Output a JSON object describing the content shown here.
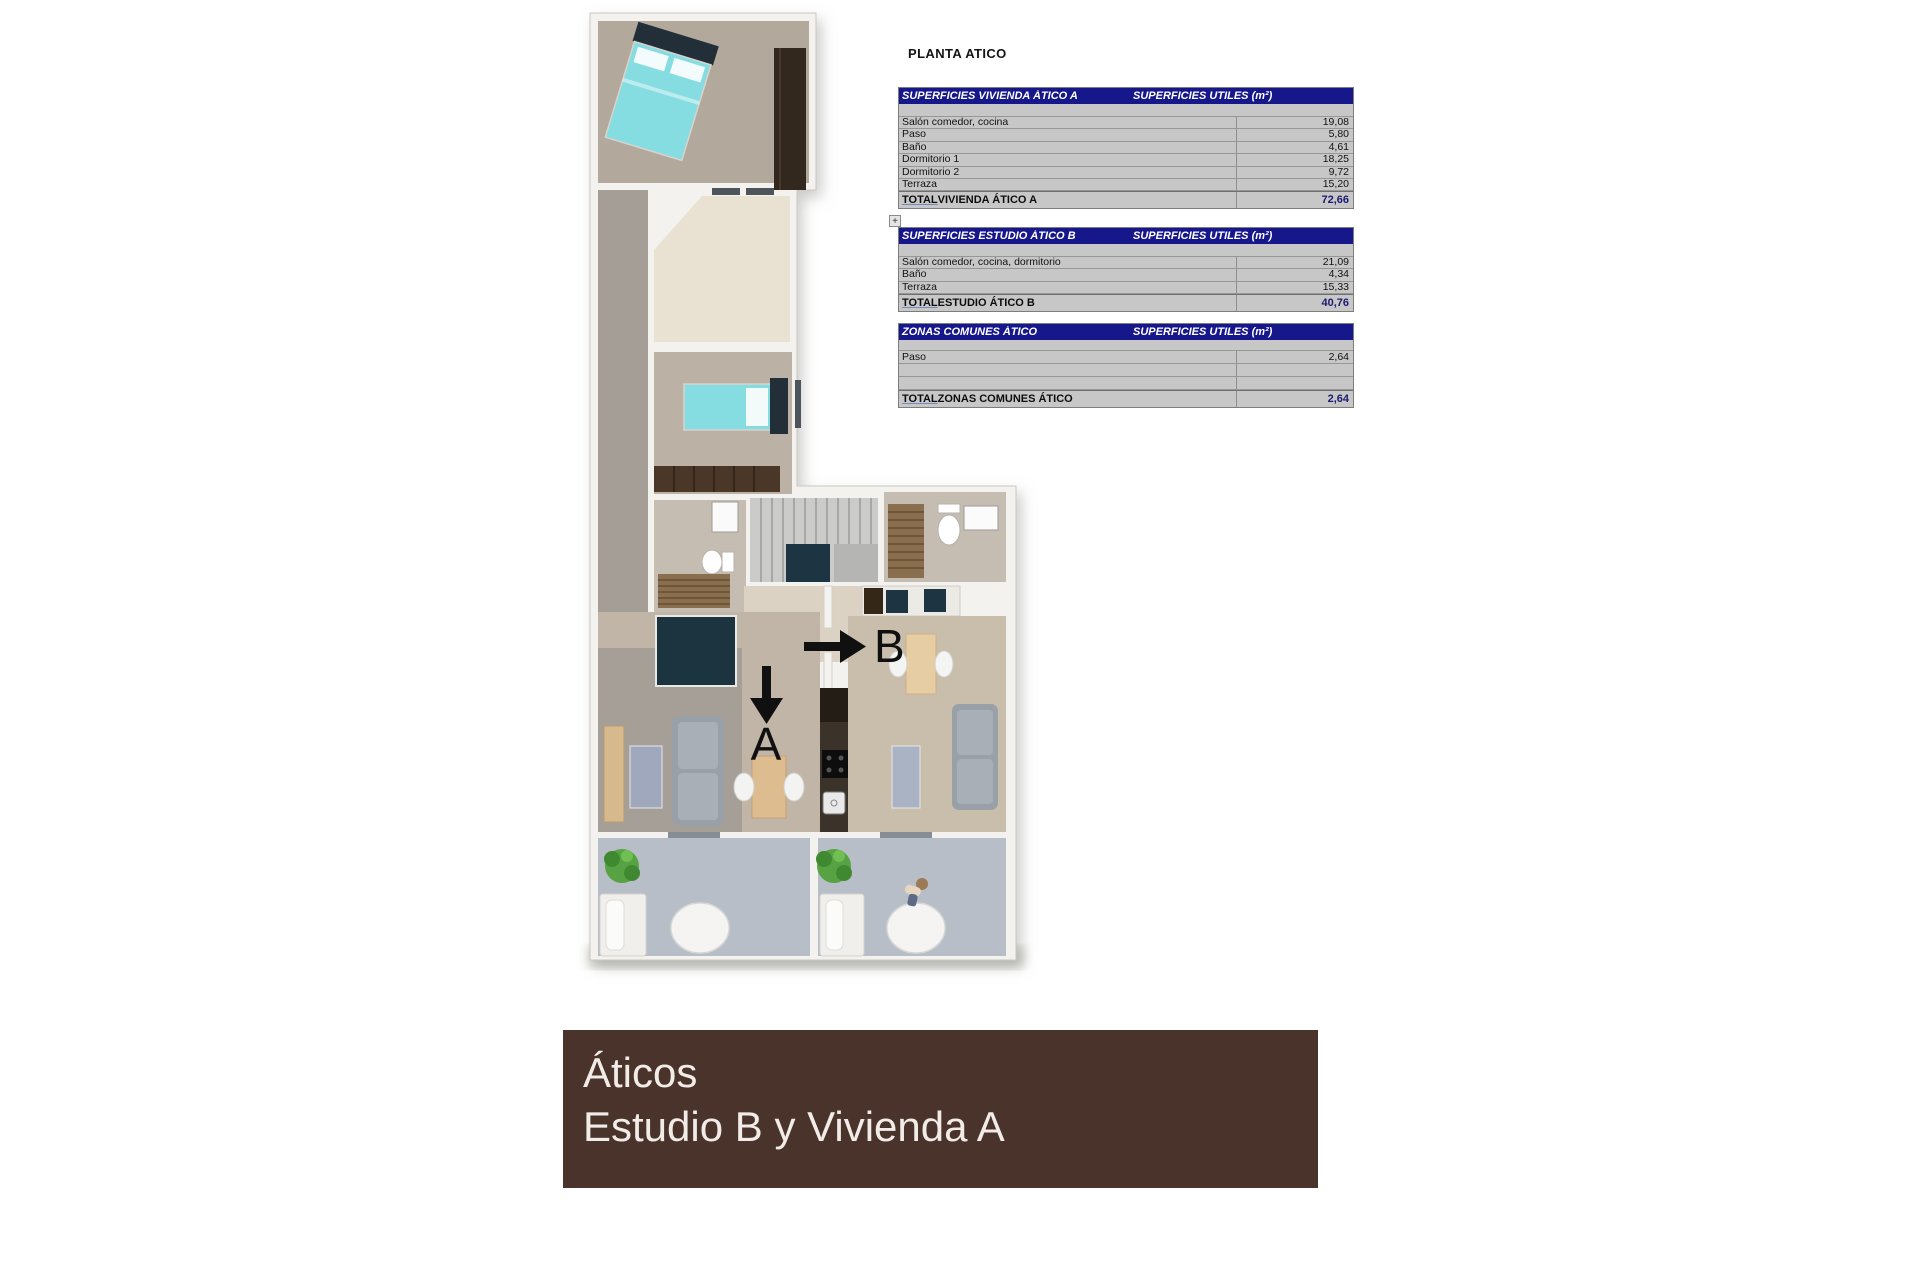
{
  "page_title": "PLANTA ATICO",
  "expand_icon_label": "+",
  "colors": {
    "table_header_bg": "#17178c",
    "table_header_fg": "#ffffff",
    "table_body_bg": "#c7c7c7",
    "total_value_fg": "#1b1b70",
    "banner_bg": "#4a332b",
    "banner_fg": "#f2ece8",
    "bed_teal": "#85dde1",
    "navy_block": "#1c3340",
    "terrace_floor": "#b8bec7"
  },
  "tables": [
    {
      "title": "SUPERFICIES VIVIENDA ÁTICO A",
      "units_header": "SUPERFICIES UTILES  (m²)",
      "rows": [
        [
          "Salón comedor, cocina",
          "19,08"
        ],
        [
          "Paso",
          "5,80"
        ],
        [
          "Baño",
          "4,61"
        ],
        [
          "Dormitorio 1",
          "18,25"
        ],
        [
          "Dormitorio 2",
          "9,72"
        ],
        [
          "Terraza",
          "15,20"
        ]
      ],
      "total_word": "TOTAL",
      "total_label": " VIVIENDA ÁTICO A",
      "total_value": "72,66"
    },
    {
      "title": "SUPERFICIES ESTUDIO ÁTICO B",
      "units_header": "SUPERFICIES UTILES  (m²)",
      "rows": [
        [
          "Salón comedor, cocina, dormitorio",
          "21,09"
        ],
        [
          "Baño",
          "4,34"
        ],
        [
          "Terraza",
          "15,33"
        ]
      ],
      "total_word": "TOTAL",
      "total_label": " ESTUDIO ÁTICO B",
      "total_value": "40,76"
    },
    {
      "title": "ZONAS COMUNES ÁTICO",
      "units_header": "SUPERFICIES UTILES  (m²)",
      "rows": [
        [
          "Paso",
          "2,64"
        ],
        [
          "",
          ""
        ],
        [
          "",
          ""
        ]
      ],
      "total_word": "TOTAL",
      "total_label": " ZONAS COMUNES ÁTICO",
      "total_value": "2,64"
    }
  ],
  "plan": {
    "arrow_a": "A",
    "arrow_b": "B"
  },
  "banner": {
    "line1": "Áticos",
    "line2": "Estudio B y Vivienda A"
  }
}
